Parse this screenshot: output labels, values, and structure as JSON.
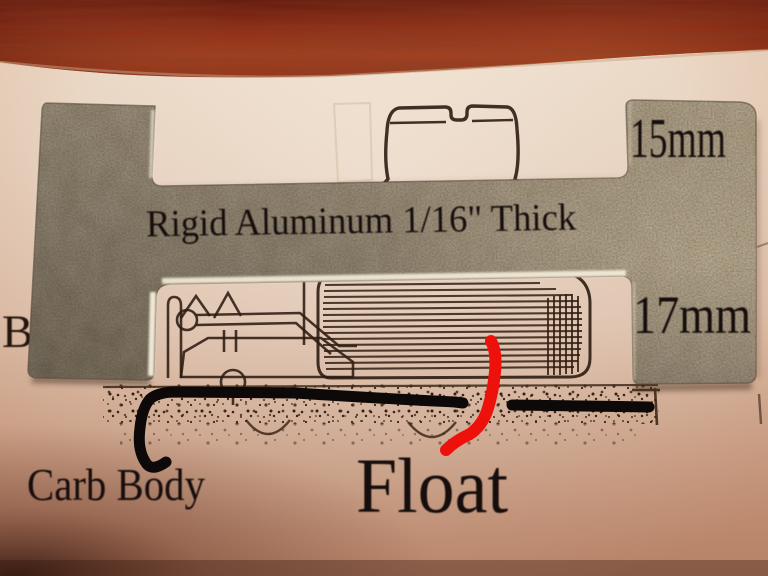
{
  "photo": {
    "annotations": {
      "thickness_label": "Rigid Aluminum 1/16\" Thick",
      "top_right_dimension": "15mm",
      "right_dimension": "17mm",
      "carb_body_label": "Carb Body",
      "float_label": "Float",
      "page_letter": "B"
    },
    "colors": {
      "wood": "#93331c",
      "paper": "#f2e6d8",
      "paper_shadow": "#c5866a",
      "aluminum": "#a2937a",
      "print_ink": "#2e1c12",
      "marker_black": "#0c0908",
      "marker_red": "#ee100a",
      "label_ink": "#16100b"
    }
  }
}
